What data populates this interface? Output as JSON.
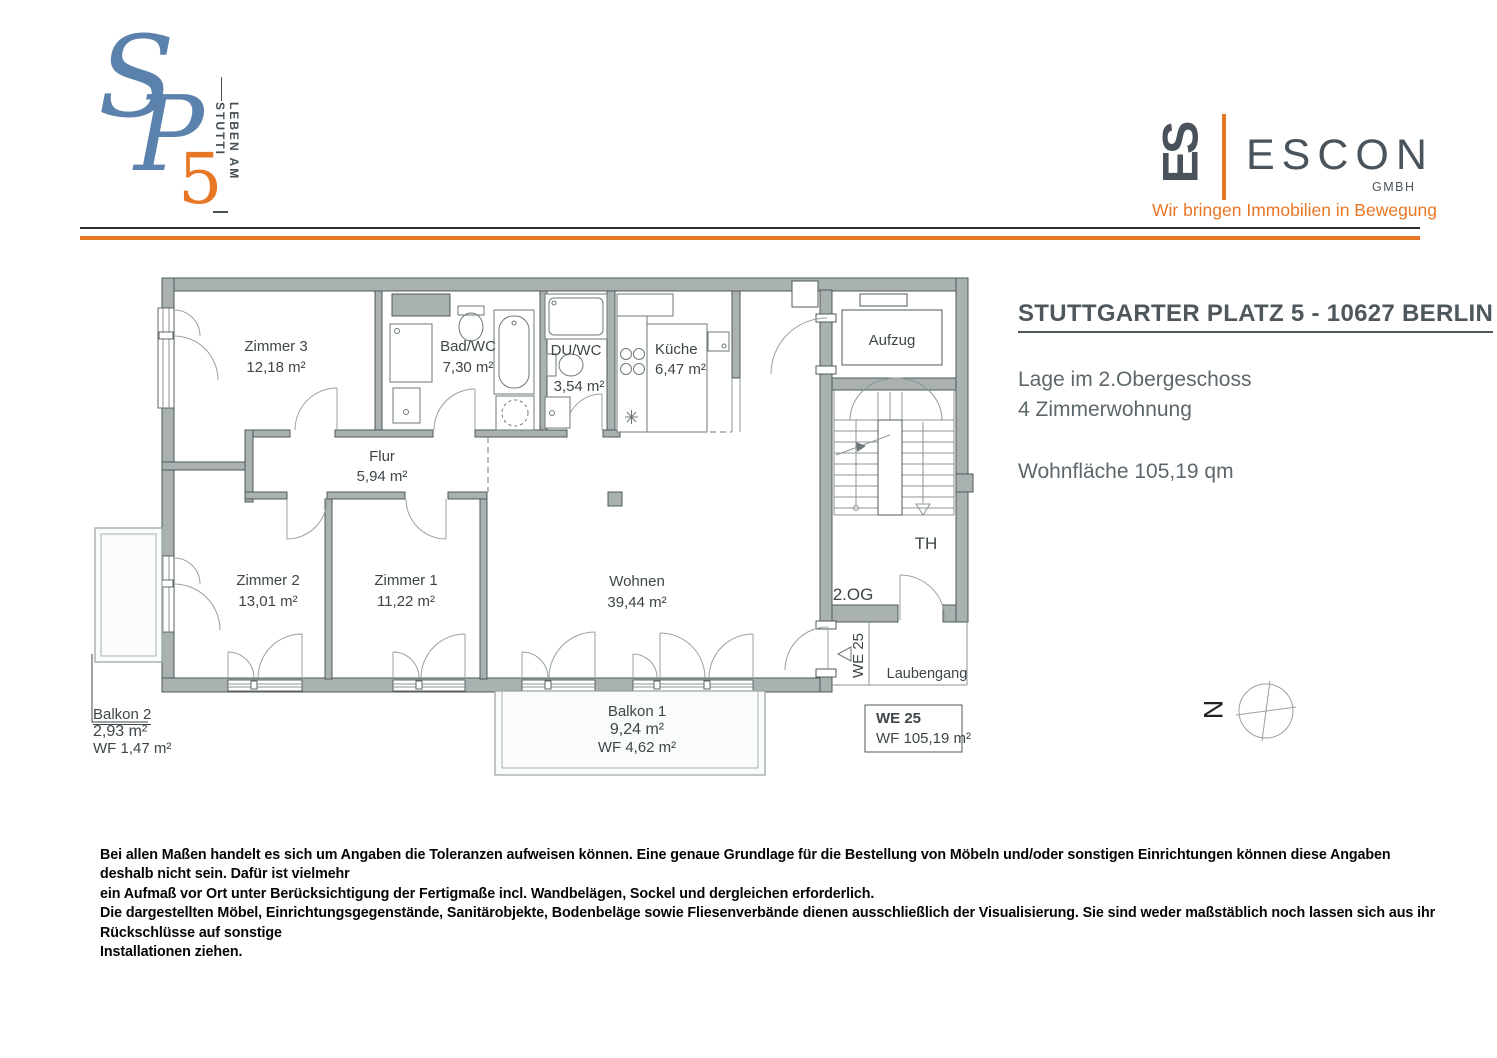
{
  "brand": {
    "sp": {
      "s": "S",
      "p": "P",
      "five": "5",
      "vertical_tagline": "LEBEN AM STUTTI",
      "blue": "#5b82ad",
      "orange": "#e87725"
    },
    "escon": {
      "mark": "ES",
      "name": "ESCON",
      "legal": "GMBH",
      "tagline": "Wir bringen Immobilien in Bewegung",
      "dark": "#4a545c",
      "orange": "#e87725"
    }
  },
  "info": {
    "title": "STUTTGARTER PLATZ 5 - 10627 BERLIN",
    "location_line": "Lage im 2.Obergeschoss",
    "type_line": "4 Zimmerwohnung",
    "area_line": "Wohnfläche 105,19 qm"
  },
  "plan": {
    "rooms": [
      {
        "name": "Zimmer 3",
        "area": "12,18 m²"
      },
      {
        "name": "Bad/WC",
        "area": "7,30 m²"
      },
      {
        "name": "DU/WC",
        "area": "3,54 m²"
      },
      {
        "name": "Küche",
        "area": "6,47 m²"
      },
      {
        "name": "Flur",
        "area": "5,94 m²"
      },
      {
        "name": "Zimmer 2",
        "area": "13,01 m²"
      },
      {
        "name": "Zimmer 1",
        "area": "11,22 m²"
      },
      {
        "name": "Wohnen",
        "area": "39,44 m²"
      }
    ],
    "balconies": [
      {
        "name": "Balkon 1",
        "area": "9,24 m²",
        "wf": "WF 4,62 m²"
      },
      {
        "name": "Balkon 2",
        "area": "2,93 m²",
        "wf": "WF 1,47 m²"
      }
    ],
    "labels": {
      "elevator": "Aufzug",
      "stairwell": "TH",
      "floor": "2.OG",
      "unit": "WE 25",
      "gallery": "Laubengang",
      "north": "N"
    },
    "unit_box": {
      "id": "WE 25",
      "wf": "WF 105,19 m²"
    },
    "colors": {
      "wall": "#a9b2b1",
      "wall_outline": "#4f585a",
      "orange": "#e87725"
    }
  },
  "disclaimer": [
    "Bei allen Maßen handelt es sich um Angaben die Toleranzen aufweisen können. Eine genaue Grundlage für die Bestellung von Möbeln und/oder sonstigen Einrichtungen können diese Angaben deshalb nicht sein. Dafür ist vielmehr",
    "ein Aufmaß vor Ort unter Berücksichtigung der Fertigmaße incl. Wandbelägen, Sockel und dergleichen erforderlich.",
    "Die dargestellten Möbel, Einrichtungsgegenstände, Sanitärobjekte, Bodenbeläge sowie Fliesenverbände dienen ausschließlich der Visualisierung. Sie sind weder maßstäblich noch lassen sich aus ihr Rückschlüsse auf sonstige",
    "Installationen ziehen."
  ]
}
